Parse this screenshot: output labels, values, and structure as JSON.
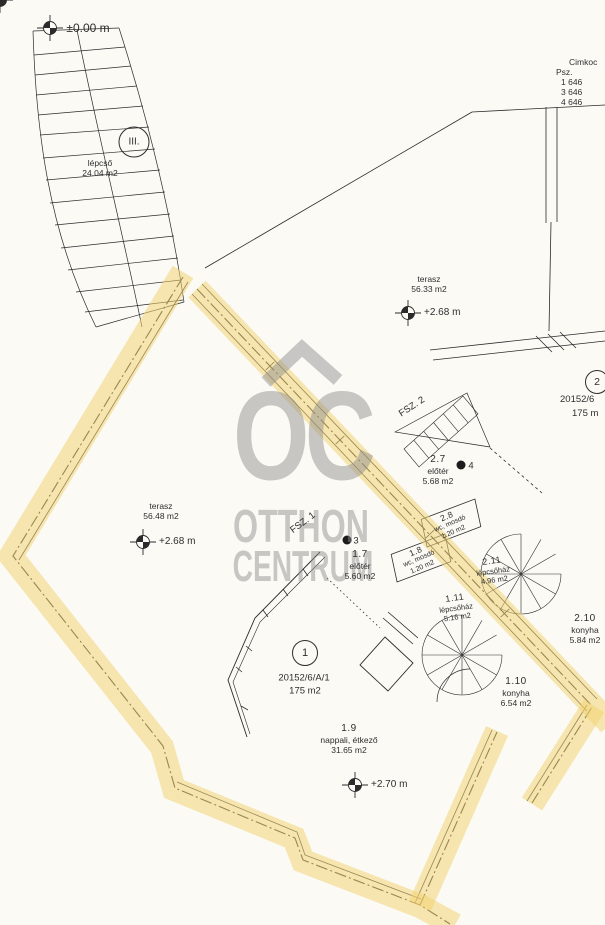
{
  "plan_title": "floor plan (ground floor) with highlighted unit outline",
  "colors": {
    "highlight_yellow": "#f3d472",
    "watermark_gray": "#8f8f8f",
    "ink": "#2e2e2e",
    "paper": "#fbfaf5"
  },
  "benchmark_top": {
    "label": "±0.00 m"
  },
  "corner_note": {
    "title": "Cimkoc",
    "subtitle": "Psz.",
    "rows": [
      "1  646",
      "3  646",
      "4  646"
    ]
  },
  "stairwell": {
    "badge": "III.",
    "name": "lépcső",
    "area": "24.04 m2"
  },
  "terrace_upper": {
    "name": "terasz",
    "area": "56.33 m2",
    "level": "+2.68 m"
  },
  "terrace_lower": {
    "name": "terasz",
    "area": "56.48 m2",
    "level": "+2.68 m"
  },
  "unit2": {
    "badge": "2",
    "lot": "20152/6",
    "area": "175 m"
  },
  "unit1": {
    "badge": "1",
    "lot": "20152/6/A/1",
    "area": "175 m2"
  },
  "fsz2": {
    "label": "FSZ. 2"
  },
  "fsz1": {
    "label": "FSZ. 1"
  },
  "rooms": {
    "dot3": "3",
    "dot4": "4",
    "r27": {
      "id": "2.7",
      "name": "előtér",
      "area": "5.68 m2"
    },
    "r17": {
      "id": "1.7",
      "name": "előtér",
      "area": "5.60 m2"
    },
    "r28": {
      "id": "2.8",
      "name": "wc, mosdó",
      "area": "1.20 m2"
    },
    "r18": {
      "id": "1.8",
      "name": "wc, mosdó",
      "area": "1.20 m2"
    },
    "r211": {
      "id": "2.11",
      "name": "lépcsőház",
      "area": "4.96 m2"
    },
    "r111": {
      "id": "1.11",
      "name": "lépcsőház",
      "area": "5.16 m2"
    },
    "r210": {
      "id": "2.10",
      "name": "konyha",
      "area": "5.84 m2"
    },
    "r110": {
      "id": "1.10",
      "name": "konyha",
      "area": "6.54 m2"
    },
    "r19": {
      "id": "1.9",
      "name": "nappali, étkező",
      "area": "31.65 m2",
      "level": "+2.70 m"
    }
  },
  "watermark": {
    "monogram": "OC",
    "line1": "OTTHON",
    "line2": "CENTRUM"
  }
}
